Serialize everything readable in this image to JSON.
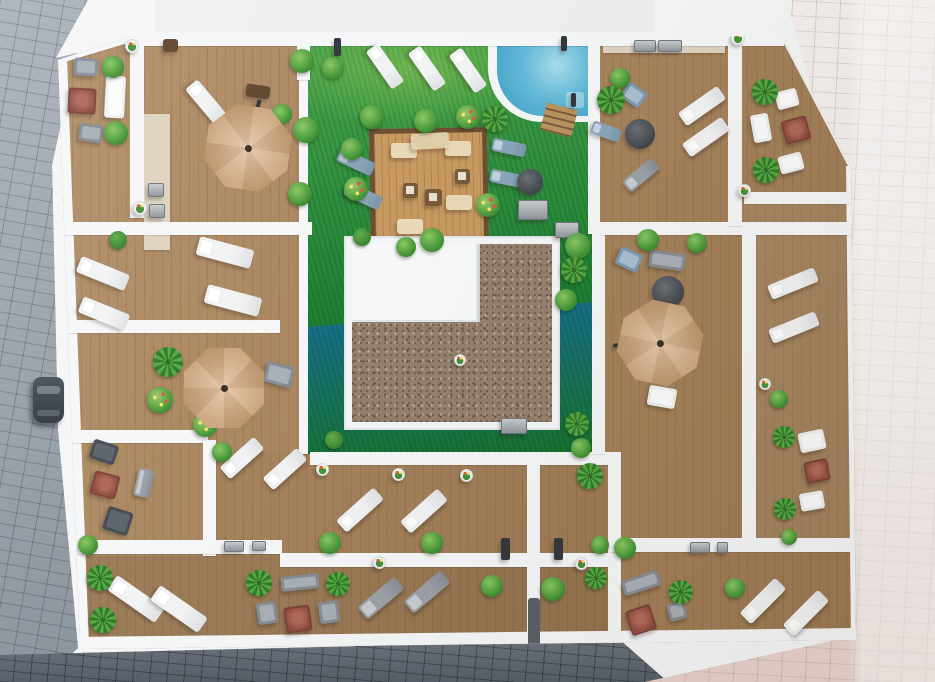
{
  "scene": {
    "kind": "aerial-3d-render-rooftop-terraces",
    "visible_text": []
  },
  "palette": {
    "white_base": "#f5f6f7",
    "wall": "#f5f7f8",
    "wood": "#ab855a",
    "lawn": "#2d8a3a",
    "pool": "#3d9ec6",
    "pool_light": "#a9dcec",
    "gravel": "#94806d",
    "street_left": "#99a1a9",
    "street_bottom": "#666e78",
    "street_right": "#efe9e7",
    "umbrella": "#d9b28a",
    "accent_red": "#8e4b3f",
    "plant_dark": "#2f7a2a"
  },
  "walls": [
    [
      130,
      38,
      14,
      180
    ],
    [
      58,
      222,
      254,
      13
    ],
    [
      299,
      44,
      9,
      410
    ],
    [
      58,
      320,
      222,
      13
    ],
    [
      58,
      430,
      150,
      13
    ],
    [
      203,
      440,
      13,
      116
    ],
    [
      58,
      540,
      224,
      14
    ],
    [
      280,
      553,
      332,
      14
    ],
    [
      310,
      452,
      298,
      13
    ],
    [
      527,
      452,
      13,
      198
    ],
    [
      608,
      452,
      13,
      198
    ],
    [
      588,
      36,
      12,
      198
    ],
    [
      592,
      232,
      13,
      222
    ],
    [
      600,
      222,
      250,
      13
    ],
    [
      728,
      36,
      14,
      190
    ],
    [
      742,
      224,
      14,
      316
    ],
    [
      610,
      538,
      240,
      14
    ],
    [
      744,
      192,
      106,
      12
    ],
    [
      297,
      38,
      13,
      42
    ]
  ],
  "items": [
    {
      "t": "umbrella",
      "x": 248,
      "y": 148,
      "w": 84,
      "h": 84,
      "a": 8
    },
    {
      "t": "umbrella",
      "x": 224,
      "y": 388,
      "w": 80,
      "h": 80,
      "a": 0
    },
    {
      "t": "umbrella",
      "x": 660,
      "y": 343,
      "w": 82,
      "h": 82,
      "a": 12
    },
    {
      "t": "arm",
      "x": 254,
      "y": 122,
      "w": 4,
      "h": 46,
      "a": 14
    },
    {
      "t": "arm",
      "x": 636,
      "y": 344,
      "w": 46,
      "h": 4,
      "a": -4
    },
    {
      "t": "lounger-white",
      "x": 206,
      "y": 102,
      "w": 46,
      "h": 16,
      "a": 50
    },
    {
      "t": "lounger-white",
      "x": 385,
      "y": 66,
      "w": 46,
      "h": 15,
      "a": 55
    },
    {
      "t": "lounger-white",
      "x": 427,
      "y": 68,
      "w": 46,
      "h": 15,
      "a": 55
    },
    {
      "t": "lounger-white",
      "x": 468,
      "y": 70,
      "w": 46,
      "h": 15,
      "a": 55
    },
    {
      "t": "lounger-white",
      "x": 225,
      "y": 252,
      "w": 56,
      "h": 19,
      "a": 15
    },
    {
      "t": "lounger-white",
      "x": 233,
      "y": 300,
      "w": 56,
      "h": 19,
      "a": 15
    },
    {
      "t": "lounger-white",
      "x": 103,
      "y": 273,
      "w": 52,
      "h": 17,
      "a": 22
    },
    {
      "t": "lounger-white",
      "x": 104,
      "y": 313,
      "w": 50,
      "h": 17,
      "a": 22
    },
    {
      "t": "lounger-white",
      "x": 242,
      "y": 458,
      "w": 46,
      "h": 16,
      "a": -42
    },
    {
      "t": "lounger-white",
      "x": 285,
      "y": 469,
      "w": 46,
      "h": 16,
      "a": -42
    },
    {
      "t": "lounger-white",
      "x": 360,
      "y": 510,
      "w": 50,
      "h": 16,
      "a": -42
    },
    {
      "t": "lounger-white",
      "x": 424,
      "y": 511,
      "w": 50,
      "h": 16,
      "a": -42
    },
    {
      "t": "lounger-white",
      "x": 136,
      "y": 599,
      "w": 58,
      "h": 18,
      "a": 35
    },
    {
      "t": "lounger-white",
      "x": 179,
      "y": 609,
      "w": 58,
      "h": 18,
      "a": 35
    },
    {
      "t": "lounger-white",
      "x": 763,
      "y": 601,
      "w": 50,
      "h": 16,
      "a": -45
    },
    {
      "t": "lounger-white",
      "x": 806,
      "y": 613,
      "w": 50,
      "h": 16,
      "a": -45
    },
    {
      "t": "lounger-white",
      "x": 702,
      "y": 106,
      "w": 48,
      "h": 16,
      "a": -35
    },
    {
      "t": "lounger-white",
      "x": 706,
      "y": 137,
      "w": 48,
      "h": 16,
      "a": -35
    },
    {
      "t": "lounger-white",
      "x": 793,
      "y": 283,
      "w": 50,
      "h": 15,
      "a": -22
    },
    {
      "t": "lounger-white",
      "x": 794,
      "y": 327,
      "w": 50,
      "h": 15,
      "a": -22
    },
    {
      "t": "seat-white",
      "x": 812,
      "y": 501,
      "w": 24,
      "h": 18,
      "a": -10
    },
    {
      "t": "seat-white",
      "x": 787,
      "y": 99,
      "w": 22,
      "h": 18,
      "a": -15
    },
    {
      "t": "seat-white",
      "x": 761,
      "y": 128,
      "w": 18,
      "h": 28,
      "a": -10
    },
    {
      "t": "seat-white",
      "x": 791,
      "y": 163,
      "w": 24,
      "h": 18,
      "a": -15
    },
    {
      "t": "seat-white",
      "x": 812,
      "y": 441,
      "w": 26,
      "h": 20,
      "a": -12
    },
    {
      "t": "seat-white",
      "x": 115,
      "y": 97,
      "w": 20,
      "h": 42,
      "a": 3
    },
    {
      "t": "seat-white",
      "x": 662,
      "y": 397,
      "w": 28,
      "h": 20,
      "a": 10
    },
    {
      "t": "lounger-gray",
      "x": 381,
      "y": 598,
      "w": 48,
      "h": 16,
      "a": -40
    },
    {
      "t": "lounger-gray",
      "x": 427,
      "y": 592,
      "w": 48,
      "h": 16,
      "a": -40
    },
    {
      "t": "lounger-gray",
      "x": 641,
      "y": 175,
      "w": 38,
      "h": 14,
      "a": -40
    },
    {
      "t": "lounger-gray",
      "x": 144,
      "y": 483,
      "w": 16,
      "h": 28,
      "a": 12
    },
    {
      "t": "chair-gray",
      "x": 86,
      "y": 67,
      "w": 24,
      "h": 18,
      "a": 3
    },
    {
      "t": "chair-gray",
      "x": 91,
      "y": 133,
      "w": 24,
      "h": 18,
      "a": 8
    },
    {
      "t": "chair-gray",
      "x": 279,
      "y": 374,
      "w": 28,
      "h": 21,
      "a": 15
    },
    {
      "t": "chair-gray",
      "x": 329,
      "y": 612,
      "w": 20,
      "h": 22,
      "a": -8
    },
    {
      "t": "chair-gray",
      "x": 267,
      "y": 613,
      "w": 20,
      "h": 22,
      "a": -8
    },
    {
      "t": "chair-gray",
      "x": 677,
      "y": 611,
      "w": 18,
      "h": 18,
      "a": -15
    },
    {
      "t": "sofa-gray",
      "x": 667,
      "y": 260,
      "w": 36,
      "h": 17,
      "a": 8
    },
    {
      "t": "sofa-gray",
      "x": 300,
      "y": 582,
      "w": 38,
      "h": 15,
      "a": -6
    },
    {
      "t": "sofa-gray",
      "x": 641,
      "y": 583,
      "w": 38,
      "h": 16,
      "a": -18
    },
    {
      "t": "sofa-dark",
      "x": 104,
      "y": 452,
      "w": 26,
      "h": 20,
      "a": 18
    },
    {
      "t": "sofa-dark",
      "x": 118,
      "y": 521,
      "w": 26,
      "h": 24,
      "a": 18
    },
    {
      "t": "lounger-blue",
      "x": 356,
      "y": 162,
      "w": 38,
      "h": 14,
      "a": 25
    },
    {
      "t": "lounger-blue",
      "x": 363,
      "y": 196,
      "w": 38,
      "h": 14,
      "a": 25
    },
    {
      "t": "lounger-blue",
      "x": 509,
      "y": 147,
      "w": 34,
      "h": 13,
      "a": 12
    },
    {
      "t": "lounger-blue",
      "x": 507,
      "y": 178,
      "w": 34,
      "h": 13,
      "a": 12
    },
    {
      "t": "lounger-blue",
      "x": 606,
      "y": 131,
      "w": 30,
      "h": 13,
      "a": 20
    },
    {
      "t": "chair-blue",
      "x": 634,
      "y": 95,
      "w": 22,
      "h": 18,
      "a": 35
    },
    {
      "t": "chair-blue",
      "x": 629,
      "y": 259,
      "w": 24,
      "h": 19,
      "a": 25
    },
    {
      "t": "table-red",
      "x": 82,
      "y": 101,
      "w": 28,
      "h": 26,
      "a": 3
    },
    {
      "t": "table-red",
      "x": 105,
      "y": 485,
      "w": 26,
      "h": 24,
      "a": 15
    },
    {
      "t": "table-red",
      "x": 298,
      "y": 619,
      "w": 26,
      "h": 26,
      "a": -8
    },
    {
      "t": "table-red",
      "x": 641,
      "y": 620,
      "w": 26,
      "h": 26,
      "a": -18
    },
    {
      "t": "table-red",
      "x": 796,
      "y": 130,
      "w": 26,
      "h": 24,
      "a": -15
    },
    {
      "t": "table-red",
      "x": 817,
      "y": 471,
      "w": 24,
      "h": 22,
      "a": -12
    },
    {
      "t": "table-brown",
      "x": 258,
      "y": 91,
      "w": 24,
      "h": 13,
      "a": 8
    },
    {
      "t": "table-brown",
      "x": 170,
      "y": 45,
      "w": 15,
      "h": 13,
      "a": 0
    },
    {
      "t": "table-round",
      "x": 640,
      "y": 134,
      "w": 30,
      "h": 30,
      "a": 0
    },
    {
      "t": "table-round",
      "x": 668,
      "y": 292,
      "w": 32,
      "h": 32,
      "a": 0
    },
    {
      "t": "table-round",
      "x": 530,
      "y": 182,
      "w": 26,
      "h": 26,
      "a": 0
    },
    {
      "t": "ptable",
      "x": 410,
      "y": 190,
      "w": 15,
      "h": 15,
      "a": 0
    },
    {
      "t": "ptable",
      "x": 433,
      "y": 197,
      "w": 17,
      "h": 17,
      "a": 0
    },
    {
      "t": "ptable",
      "x": 462,
      "y": 176,
      "w": 15,
      "h": 15,
      "a": 0
    },
    {
      "t": "cushion",
      "x": 404,
      "y": 150,
      "w": 26,
      "h": 15,
      "a": 0
    },
    {
      "t": "cushion",
      "x": 458,
      "y": 148,
      "w": 26,
      "h": 15,
      "a": 0
    },
    {
      "t": "cushion",
      "x": 410,
      "y": 226,
      "w": 26,
      "h": 15,
      "a": 0
    },
    {
      "t": "cushion",
      "x": 459,
      "y": 202,
      "w": 26,
      "h": 15,
      "a": 0
    },
    {
      "t": "rug",
      "x": 430,
      "y": 141,
      "w": 38,
      "h": 16,
      "a": -3
    },
    {
      "t": "equip",
      "x": 156,
      "y": 190,
      "w": 16,
      "h": 14,
      "a": 0
    },
    {
      "t": "equip",
      "x": 157,
      "y": 211,
      "w": 16,
      "h": 14,
      "a": 0
    },
    {
      "t": "equip",
      "x": 645,
      "y": 46,
      "w": 22,
      "h": 12,
      "a": 0
    },
    {
      "t": "equip",
      "x": 670,
      "y": 46,
      "w": 24,
      "h": 12,
      "a": 0
    },
    {
      "t": "equip",
      "x": 234,
      "y": 546,
      "w": 20,
      "h": 11,
      "a": 0
    },
    {
      "t": "equip",
      "x": 259,
      "y": 546,
      "w": 14,
      "h": 10,
      "a": 0
    },
    {
      "t": "equip",
      "x": 700,
      "y": 547,
      "w": 20,
      "h": 11,
      "a": 0
    },
    {
      "t": "equip",
      "x": 722,
      "y": 547,
      "w": 11,
      "h": 11,
      "a": 0
    },
    {
      "t": "equip",
      "x": 533,
      "y": 210,
      "w": 30,
      "h": 20,
      "a": 0
    },
    {
      "t": "equip",
      "x": 567,
      "y": 230,
      "w": 24,
      "h": 16,
      "a": 0
    },
    {
      "t": "equip",
      "x": 514,
      "y": 426,
      "w": 26,
      "h": 16,
      "a": 0
    },
    {
      "t": "post",
      "x": 337,
      "y": 47,
      "w": 7,
      "h": 18,
      "a": 0
    },
    {
      "t": "post",
      "x": 564,
      "y": 43,
      "w": 6,
      "h": 15,
      "a": 0
    },
    {
      "t": "post",
      "x": 505,
      "y": 549,
      "w": 9,
      "h": 22,
      "a": 0
    },
    {
      "t": "post",
      "x": 558,
      "y": 549,
      "w": 9,
      "h": 22,
      "a": 0
    },
    {
      "t": "post",
      "x": 573,
      "y": 100,
      "w": 5,
      "h": 14,
      "a": 0
    },
    {
      "t": "door-dark",
      "x": 534,
      "y": 622,
      "w": 12,
      "h": 48,
      "a": 0
    },
    {
      "t": "bush",
      "x": 113,
      "y": 67,
      "w": 22,
      "h": 22
    },
    {
      "t": "bush",
      "x": 116,
      "y": 133,
      "w": 24,
      "h": 24
    },
    {
      "t": "bush",
      "x": 302,
      "y": 61,
      "w": 24,
      "h": 24
    },
    {
      "t": "bush",
      "x": 306,
      "y": 130,
      "w": 26,
      "h": 26
    },
    {
      "t": "bush",
      "x": 300,
      "y": 194,
      "w": 24,
      "h": 24
    },
    {
      "t": "bush",
      "x": 282,
      "y": 114,
      "w": 20,
      "h": 20
    },
    {
      "t": "bush",
      "x": 333,
      "y": 68,
      "w": 22,
      "h": 22
    },
    {
      "t": "bush",
      "x": 372,
      "y": 117,
      "w": 24,
      "h": 24
    },
    {
      "t": "bush",
      "x": 426,
      "y": 121,
      "w": 24,
      "h": 24
    },
    {
      "t": "bush",
      "x": 352,
      "y": 149,
      "w": 22,
      "h": 22
    },
    {
      "t": "bush",
      "x": 432,
      "y": 240,
      "w": 24,
      "h": 24
    },
    {
      "t": "bush",
      "x": 406,
      "y": 247,
      "w": 20,
      "h": 20
    },
    {
      "t": "bush",
      "x": 578,
      "y": 246,
      "w": 26,
      "h": 26
    },
    {
      "t": "bush",
      "x": 566,
      "y": 300,
      "w": 22,
      "h": 22
    },
    {
      "t": "bush",
      "x": 581,
      "y": 448,
      "w": 20,
      "h": 20
    },
    {
      "t": "bush",
      "x": 222,
      "y": 452,
      "w": 20,
      "h": 20
    },
    {
      "t": "bush",
      "x": 88,
      "y": 545,
      "w": 20,
      "h": 20
    },
    {
      "t": "bush",
      "x": 330,
      "y": 543,
      "w": 22,
      "h": 22
    },
    {
      "t": "bush",
      "x": 432,
      "y": 543,
      "w": 22,
      "h": 22
    },
    {
      "t": "bush",
      "x": 492,
      "y": 586,
      "w": 22,
      "h": 22
    },
    {
      "t": "bush",
      "x": 553,
      "y": 589,
      "w": 24,
      "h": 24
    },
    {
      "t": "bush",
      "x": 600,
      "y": 545,
      "w": 18,
      "h": 18
    },
    {
      "t": "bush",
      "x": 625,
      "y": 548,
      "w": 22,
      "h": 22
    },
    {
      "t": "bush",
      "x": 735,
      "y": 588,
      "w": 20,
      "h": 20
    },
    {
      "t": "bush",
      "x": 779,
      "y": 399,
      "w": 18,
      "h": 18
    },
    {
      "t": "bush",
      "x": 789,
      "y": 537,
      "w": 16,
      "h": 16
    },
    {
      "t": "bush",
      "x": 648,
      "y": 240,
      "w": 22,
      "h": 22
    },
    {
      "t": "bush",
      "x": 697,
      "y": 243,
      "w": 20,
      "h": 20
    },
    {
      "t": "bush",
      "x": 620,
      "y": 78,
      "w": 20,
      "h": 20
    },
    {
      "t": "palm",
      "x": 495,
      "y": 119,
      "w": 26,
      "h": 26
    },
    {
      "t": "palm",
      "x": 611,
      "y": 100,
      "w": 28,
      "h": 28
    },
    {
      "t": "palm",
      "x": 574,
      "y": 270,
      "w": 26,
      "h": 26
    },
    {
      "t": "palm",
      "x": 577,
      "y": 424,
      "w": 24,
      "h": 24
    },
    {
      "t": "palm",
      "x": 168,
      "y": 362,
      "w": 30,
      "h": 30
    },
    {
      "t": "palm",
      "x": 100,
      "y": 578,
      "w": 26,
      "h": 26
    },
    {
      "t": "palm",
      "x": 103,
      "y": 620,
      "w": 26,
      "h": 26
    },
    {
      "t": "palm",
      "x": 259,
      "y": 583,
      "w": 26,
      "h": 26
    },
    {
      "t": "palm",
      "x": 338,
      "y": 584,
      "w": 24,
      "h": 24
    },
    {
      "t": "palm",
      "x": 590,
      "y": 476,
      "w": 26,
      "h": 26
    },
    {
      "t": "palm",
      "x": 596,
      "y": 578,
      "w": 22,
      "h": 22
    },
    {
      "t": "palm",
      "x": 681,
      "y": 592,
      "w": 24,
      "h": 24
    },
    {
      "t": "palm",
      "x": 765,
      "y": 92,
      "w": 26,
      "h": 26
    },
    {
      "t": "palm",
      "x": 766,
      "y": 170,
      "w": 26,
      "h": 26
    },
    {
      "t": "palm",
      "x": 784,
      "y": 437,
      "w": 22,
      "h": 22
    },
    {
      "t": "palm",
      "x": 785,
      "y": 509,
      "w": 22,
      "h": 22
    },
    {
      "t": "flower",
      "x": 468,
      "y": 117,
      "w": 24,
      "h": 24
    },
    {
      "t": "flower",
      "x": 488,
      "y": 205,
      "w": 24,
      "h": 24
    },
    {
      "t": "flower",
      "x": 356,
      "y": 189,
      "w": 24,
      "h": 24
    },
    {
      "t": "flower",
      "x": 160,
      "y": 400,
      "w": 26,
      "h": 26
    },
    {
      "t": "flower",
      "x": 205,
      "y": 425,
      "w": 24,
      "h": 24
    },
    {
      "t": "topiary",
      "x": 118,
      "y": 240,
      "w": 18,
      "h": 18
    },
    {
      "t": "topiary",
      "x": 362,
      "y": 237,
      "w": 18,
      "h": 18
    },
    {
      "t": "topiary",
      "x": 334,
      "y": 440,
      "w": 18,
      "h": 18
    },
    {
      "t": "pot",
      "x": 132,
      "y": 46,
      "w": 14,
      "h": 14
    },
    {
      "t": "pot",
      "x": 140,
      "y": 208,
      "w": 14,
      "h": 14
    },
    {
      "t": "pot",
      "x": 738,
      "y": 38,
      "w": 14,
      "h": 14
    },
    {
      "t": "pot",
      "x": 744,
      "y": 190,
      "w": 13,
      "h": 13
    },
    {
      "t": "pot",
      "x": 322,
      "y": 469,
      "w": 13,
      "h": 13
    },
    {
      "t": "pot",
      "x": 398,
      "y": 474,
      "w": 13,
      "h": 13
    },
    {
      "t": "pot",
      "x": 466,
      "y": 475,
      "w": 13,
      "h": 13
    },
    {
      "t": "pot",
      "x": 379,
      "y": 562,
      "w": 13,
      "h": 13
    },
    {
      "t": "pot",
      "x": 581,
      "y": 563,
      "w": 13,
      "h": 13
    },
    {
      "t": "pot",
      "x": 765,
      "y": 384,
      "w": 12,
      "h": 12
    },
    {
      "t": "pot",
      "x": 460,
      "y": 360,
      "w": 12,
      "h": 12
    }
  ]
}
